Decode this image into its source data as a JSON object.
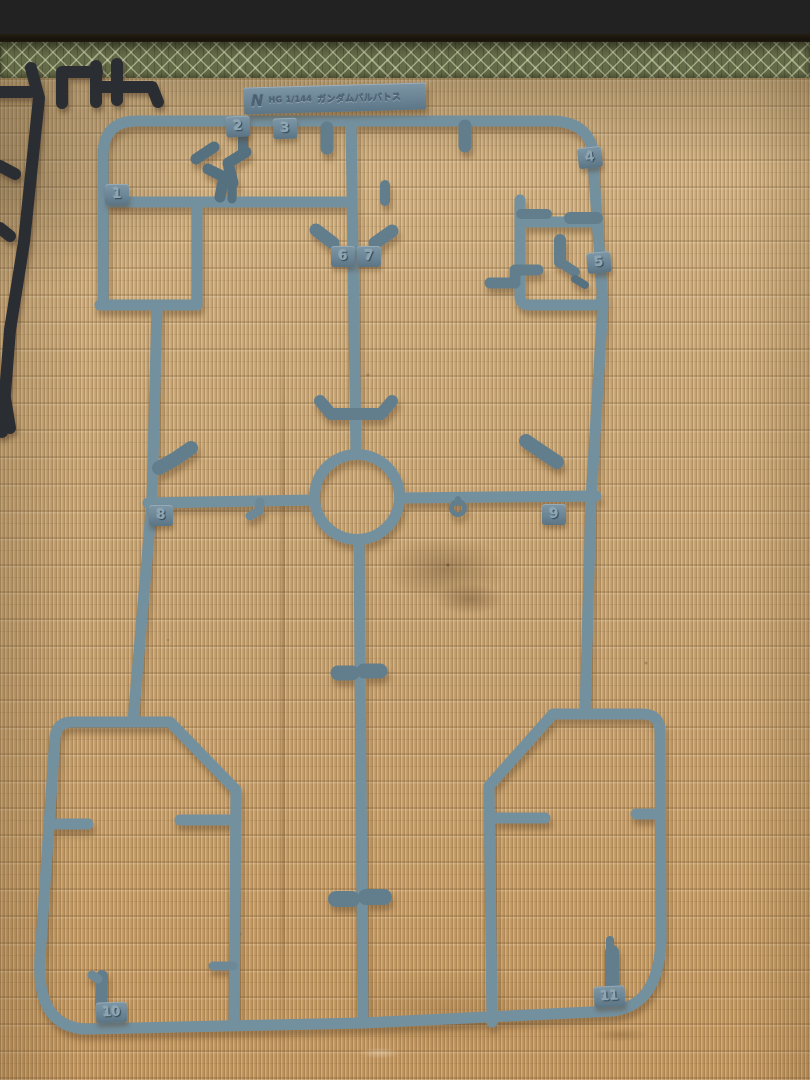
{
  "scene": {
    "label_tag": {
      "runner_letter": "N",
      "scale_text": "HG 1/144",
      "kit_name": "ガンダムバルバトス"
    },
    "gate_numbers": [
      "1",
      "2",
      "3",
      "4",
      "5",
      "6",
      "7",
      "8",
      "9",
      "10",
      "11"
    ],
    "colors": {
      "sprue_plastic_gray_blue": "#73909f",
      "sprue_plastic_shadow": "#55707e",
      "black_sprue": "#2b2e33",
      "tatami_straw": "#c9a674",
      "tatami_edge_band_green": "#646b48",
      "wood_plank_brown": "#96654a"
    }
  }
}
